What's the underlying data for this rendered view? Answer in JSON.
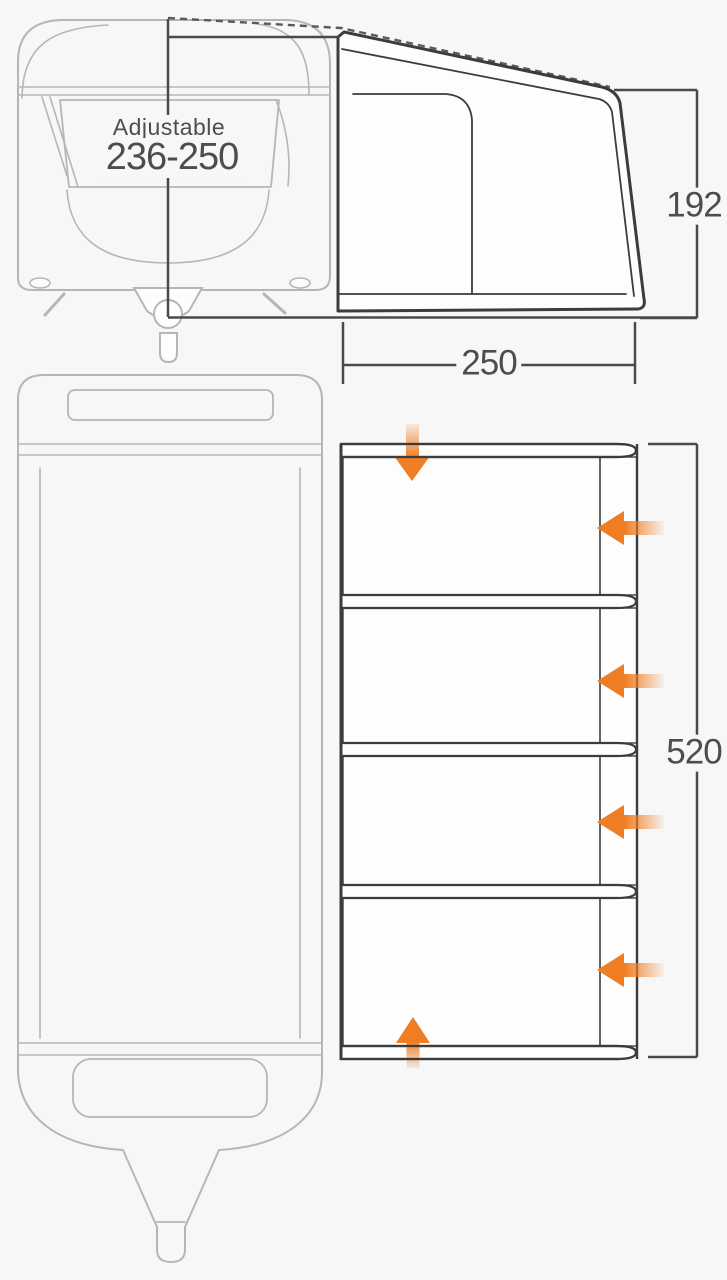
{
  "title": "Caravan awning dimension diagram",
  "dimensions": {
    "adjustable_height": {
      "label": "Adjustable",
      "value": "236-250"
    },
    "awning_width": {
      "value": "250"
    },
    "awning_height": {
      "value": "192"
    },
    "awning_depth": {
      "value": "520"
    }
  },
  "views": {
    "front_elevation": "caravan front view with adjustable height dimension",
    "side_elevation": "awning side profile with height dimension",
    "plan": "caravan and awning footprint with beam bars and door arrows"
  },
  "openings": {
    "front_arrow": "down",
    "rear_arrow": "up",
    "side_arrows": [
      "left",
      "left",
      "left",
      "left"
    ]
  },
  "beam_count": 5,
  "panel_count": 4,
  "colors": {
    "outline_dark": "#3c3c3c",
    "caravan_light": "#b6b6b6",
    "dimension": "#4a4a4a",
    "text_grey": "#4d4d4d",
    "arrow_orange": "#ef7d23",
    "background": "#f7f7f7",
    "panel_white": "#fdfdfd"
  }
}
